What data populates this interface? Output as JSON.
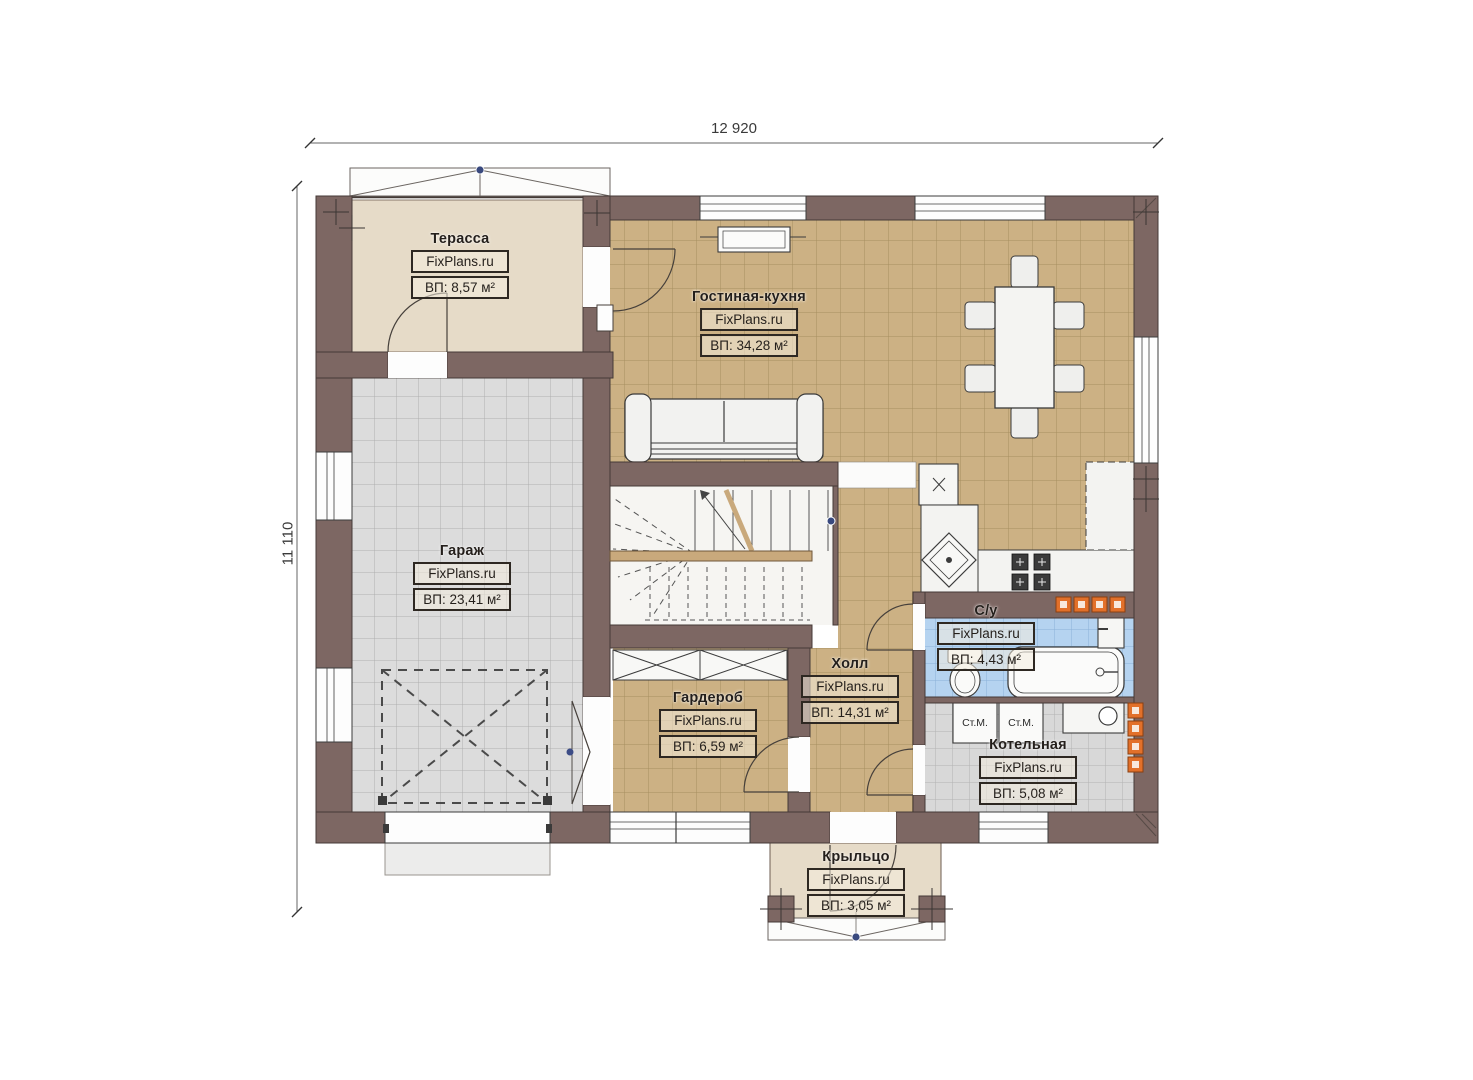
{
  "dimensions": {
    "width_label": "12 920",
    "height_label": "11 110"
  },
  "rooms": [
    {
      "key": "terrace",
      "name": "Терасса",
      "brand": "FixPlans.ru",
      "area": "ВП: 8,57 м²"
    },
    {
      "key": "living",
      "name": "Гостиная-кухня",
      "brand": "FixPlans.ru",
      "area": "ВП: 34,28 м²"
    },
    {
      "key": "garage",
      "name": "Гараж",
      "brand": "FixPlans.ru",
      "area": "ВП: 23,41 м²"
    },
    {
      "key": "hall",
      "name": "Холл",
      "brand": "FixPlans.ru",
      "area": "ВП: 14,31 м²"
    },
    {
      "key": "wardrobe",
      "name": "Гардероб",
      "brand": "FixPlans.ru",
      "area": "ВП: 6,59 м²"
    },
    {
      "key": "bathroom",
      "name": "С/у",
      "brand": "FixPlans.ru",
      "area": "ВП: 4,43 м²"
    },
    {
      "key": "boiler",
      "name": "Котельная",
      "brand": "FixPlans.ru",
      "area": "ВП: 5,08 м²"
    },
    {
      "key": "porch",
      "name": "Крыльцо",
      "brand": "FixPlans.ru",
      "area": "ВП: 3,05 м²"
    }
  ],
  "appliances": {
    "washer_left": "Ст.М.",
    "washer_right": "Ст.М."
  },
  "colors": {
    "wall": "#7d6763",
    "floor_beige": "#e6dbc8",
    "tile_tan": "#ccb184",
    "tile_grey": "#dcdcdc",
    "tile_blue": "#b5d3f0",
    "accent_orange": "#e2702a",
    "marker_blue": "#39497e"
  }
}
